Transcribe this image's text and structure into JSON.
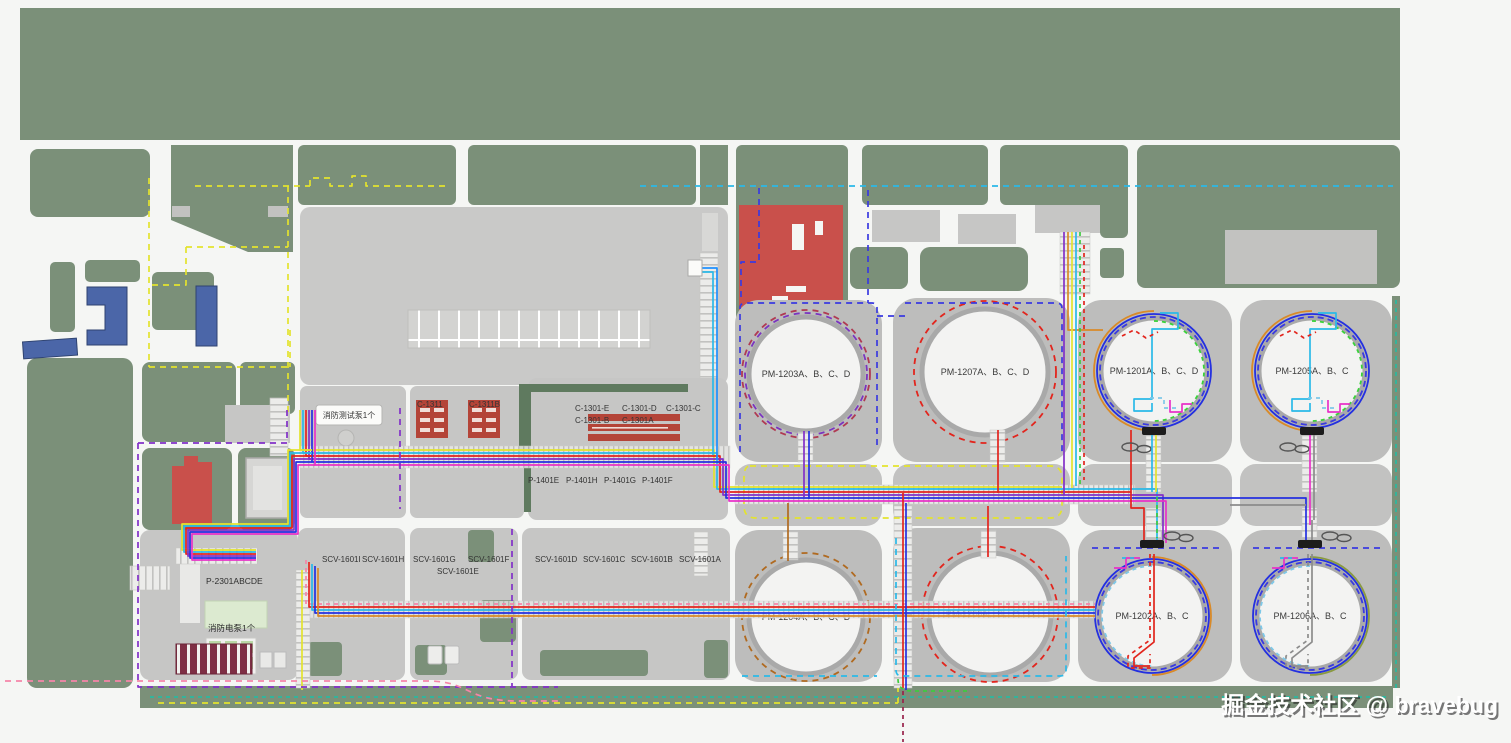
{
  "title": "厂区总平面布置与电缆走向图",
  "watermark": "掘金技术社区 @ bravebug",
  "colors": {
    "vegetation_green": "#7b9079",
    "road_white": "#f5f6f4",
    "pad_gray": "#bdbdbc",
    "block_gray": "#c6c6c5",
    "tank_fill": "#f3f3f2",
    "tank_ring": "#a9a9a9",
    "red_building": "#c9504b",
    "blue_building": "#4b66a8",
    "louver_maroon": "#7e2f45",
    "light_green_box": "#dcead0",
    "line_yellow": "#e3e32e",
    "line_cyan": "#2ab9e8",
    "line_red": "#e2251d",
    "line_purple": "#8230c8",
    "line_blue": "#2430e0",
    "line_magenta": "#e832c8",
    "line_orange": "#d98a28",
    "line_brown": "#b06a20",
    "line_green": "#3ecb3e",
    "line_teal": "#2ab8a0",
    "line_pink": "#f585a8",
    "line_navy_dashed": "#3a3ae0",
    "line_darkred_dashed": "#99224a"
  },
  "labels": {
    "fire_test_pump": "消防测试泵1个",
    "fire_electric_pump": "消防电泵1个",
    "p2301": "P-2301ABCDE",
    "c1311a": "C-1311",
    "c1311b": "C-1311B",
    "c1301": [
      "C-1301-E",
      "C-1301-D",
      "C-1301-C",
      "C-1301-B",
      "C-1301A"
    ],
    "p1401": [
      "P-1401E",
      "P-1401H",
      "P-1401G",
      "P-1401F"
    ],
    "scv": [
      "SCV-1601I",
      "SCV-1601H",
      "SCV-1601G",
      "SCV-1601F",
      "SCV-1601E",
      "SCV-1601D",
      "SCV-1601C",
      "SCV-1601B",
      "SCV-1601A"
    ]
  },
  "tanks": [
    {
      "label": "PM-1203A、B、C、D",
      "rings": [
        {
          "r": 64,
          "color": "#b03a52",
          "dash": "6 5"
        },
        {
          "r": 61,
          "color": "#7a35c0",
          "dash": "6 5"
        }
      ]
    },
    {
      "label": "PM-1207A、B、C、D",
      "rings": [
        {
          "r": 71,
          "color": "#e2251d",
          "dash": "6 5"
        }
      ]
    },
    {
      "label": "PM-1201A、B、C、D",
      "rings": [
        {
          "r": 57,
          "color": "#2430e0"
        },
        {
          "r": 54,
          "color": "#3a3ae0",
          "dash": "6 4"
        },
        {
          "r": 60,
          "color": "#d98a28",
          "arc": "left"
        },
        {
          "r": 50,
          "color": "#3ad23a",
          "dash": "4 4",
          "arc": "right"
        }
      ]
    },
    {
      "label": "PM-1205A、B、C",
      "rings": [
        {
          "r": 57,
          "color": "#2430e0"
        },
        {
          "r": 54,
          "color": "#3a3ae0",
          "dash": "6 4"
        },
        {
          "r": 60,
          "color": "#d98a28",
          "arc": "left"
        },
        {
          "r": 50,
          "color": "#3ad23a",
          "dash": "4 4",
          "arc": "right"
        }
      ]
    },
    {
      "label": "PM-1204A、B、C、D",
      "rings": [
        {
          "r": 64,
          "color": "#b06a20",
          "dash": "6 5"
        }
      ]
    },
    {
      "label": "PM-1208A、B、C、D",
      "rings": [
        {
          "r": 68,
          "color": "#e2251d",
          "dash": "6 5"
        }
      ]
    },
    {
      "label": "PM-1202A、B、C",
      "rings": [
        {
          "r": 57,
          "color": "#2430e0"
        },
        {
          "r": 54,
          "color": "#3a3ae0",
          "dash": "6 4"
        },
        {
          "r": 59,
          "color": "#d98a28",
          "arc": "right"
        },
        {
          "r": 50,
          "color": "#7ec8e8",
          "dash": "4 4",
          "arc": "left"
        }
      ]
    },
    {
      "label": "PM-1206A、B、C",
      "rings": [
        {
          "r": 57,
          "color": "#2430e0"
        },
        {
          "r": 54,
          "color": "#3a3ae0",
          "dash": "6 4"
        },
        {
          "r": 59,
          "color": "#8a9a40",
          "arc": "right"
        },
        {
          "r": 50,
          "color": "#7ec8e8",
          "dash": "4 4",
          "arc": "left"
        }
      ]
    }
  ]
}
